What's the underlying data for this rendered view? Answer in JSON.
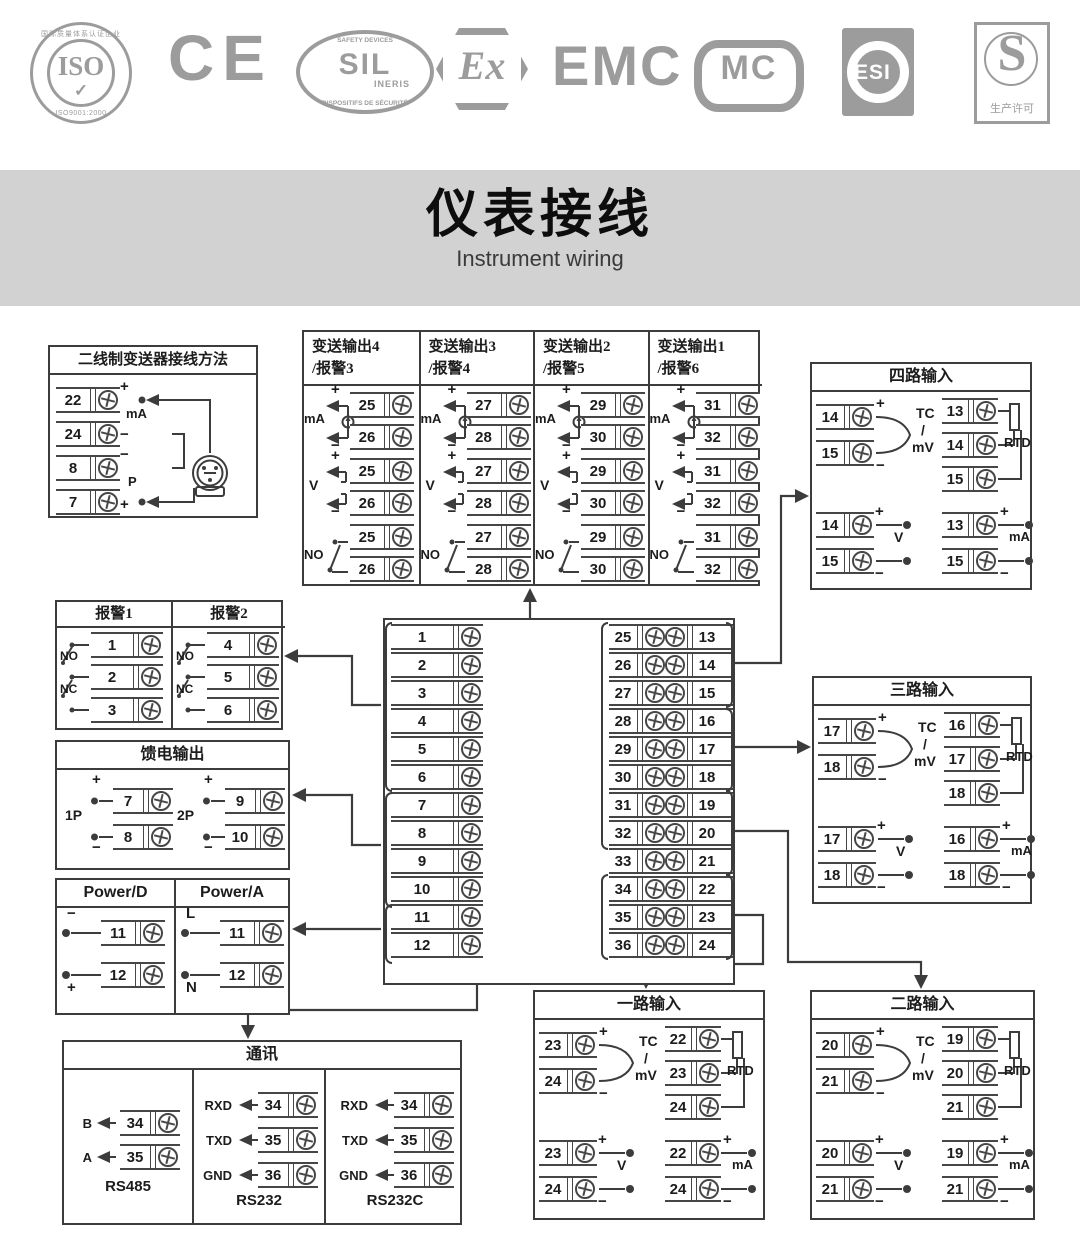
{
  "page": {
    "title_cn": "仪表接线",
    "title_en": "Instrument wiring",
    "banner_bg": "#d2d2d2",
    "line_color": "#3c3c3c",
    "logo_color": "#9c9c9c"
  },
  "logos": {
    "iso": {
      "label": "ISO",
      "ring_top": "国际质量体系认证企业",
      "ring_bottom": "ISO9001:2000",
      "check": "✓"
    },
    "ce": {
      "label": "CE"
    },
    "sil": {
      "arc_top": "SAFETY DEVICES",
      "label": "SIL",
      "sub": "INERIS",
      "arc_bottom": "DISPOSITIFS DE SÉCURITÉ"
    },
    "ex": {
      "label": "Ex"
    },
    "emc": {
      "label": "EMC"
    },
    "mc": {
      "label": "MC"
    },
    "esi": {
      "label": "ESI"
    },
    "license": {
      "label": "S",
      "caption": "生产许可"
    }
  },
  "labels": {
    "plus": "+",
    "minus": "−",
    "ma": "mA",
    "v": "V",
    "no": "NO",
    "nc": "NC",
    "tc": "TC",
    "slash": "/",
    "mv": "mV",
    "rtd": "RTD",
    "p": "P"
  },
  "two_wire_box": {
    "title": "二线制变送器接线方法",
    "rows": [
      {
        "num": "22",
        "sign": "+"
      },
      {
        "num": "24",
        "sign": "−"
      },
      {
        "num": "8",
        "sign": "−"
      },
      {
        "num": "7",
        "sign": "+"
      }
    ],
    "label_ma": "mA",
    "label_p": "P"
  },
  "transmit_box": {
    "columns": [
      {
        "title1": "变送输出4",
        "title2": "/报警3",
        "pair": [
          "25",
          "26"
        ]
      },
      {
        "title1": "变送输出3",
        "title2": "/报警4",
        "pair": [
          "27",
          "28"
        ]
      },
      {
        "title1": "变送输出2",
        "title2": "/报警5",
        "pair": [
          "29",
          "30"
        ]
      },
      {
        "title1": "变送输出1",
        "title2": "/报警6",
        "pair": [
          "31",
          "32"
        ]
      }
    ]
  },
  "input_boxes": [
    {
      "title": "四路输入",
      "tc": [
        "14",
        "15"
      ],
      "rtd": [
        "13",
        "14",
        "15"
      ],
      "v": [
        "14",
        "15"
      ],
      "ma": [
        "13",
        "15"
      ]
    },
    {
      "title": "三路输入",
      "tc": [
        "17",
        "18"
      ],
      "rtd": [
        "16",
        "17",
        "18"
      ],
      "v": [
        "17",
        "18"
      ],
      "ma": [
        "16",
        "18"
      ]
    },
    {
      "title": "一路输入",
      "tc": [
        "23",
        "24"
      ],
      "rtd": [
        "22",
        "23",
        "24"
      ],
      "v": [
        "23",
        "24"
      ],
      "ma": [
        "22",
        "24"
      ]
    },
    {
      "title": "二路输入",
      "tc": [
        "20",
        "21"
      ],
      "rtd": [
        "19",
        "20",
        "21"
      ],
      "v": [
        "20",
        "21"
      ],
      "ma": [
        "19",
        "21"
      ]
    }
  ],
  "alarm_box": {
    "columns": [
      {
        "title": "报警1",
        "terminals": [
          "1",
          "2",
          "3"
        ]
      },
      {
        "title": "报警2",
        "terminals": [
          "4",
          "5",
          "6"
        ]
      }
    ],
    "no": "NO",
    "nc": "NC"
  },
  "feed_box": {
    "title": "馈电输出",
    "groups": [
      {
        "label": "1P",
        "plus": "7",
        "minus": "8"
      },
      {
        "label": "2P",
        "plus": "9",
        "minus": "10"
      }
    ]
  },
  "power_box": {
    "columns": [
      {
        "title": "Power/D",
        "rows": [
          {
            "num": "11",
            "sign": "−"
          },
          {
            "num": "12",
            "sign": "+"
          }
        ]
      },
      {
        "title": "Power/A",
        "rows": [
          {
            "num": "11",
            "sign": "L"
          },
          {
            "num": "12",
            "sign": "N"
          }
        ]
      }
    ]
  },
  "comm_box": {
    "title": "通讯",
    "sections": [
      {
        "caption": "RS485",
        "rows": [
          {
            "sig": "B",
            "num": "34"
          },
          {
            "sig": "A",
            "num": "35"
          }
        ]
      },
      {
        "caption": "RS232",
        "rows": [
          {
            "sig": "RXD",
            "num": "34"
          },
          {
            "sig": "TXD",
            "num": "35"
          },
          {
            "sig": "GND",
            "num": "36"
          }
        ]
      },
      {
        "caption": "RS232C",
        "rows": [
          {
            "sig": "RXD",
            "num": "34"
          },
          {
            "sig": "TXD",
            "num": "35"
          },
          {
            "sig": "GND",
            "num": "36"
          }
        ]
      }
    ]
  },
  "center_block": {
    "left_terminals": [
      "1",
      "2",
      "3",
      "4",
      "5",
      "6",
      "7",
      "8",
      "9",
      "10",
      "11",
      "12"
    ],
    "mid_terminals": [
      "25",
      "26",
      "27",
      "28",
      "29",
      "30",
      "31",
      "32",
      "33",
      "34",
      "35",
      "36"
    ],
    "right_terminals": [
      "13",
      "14",
      "15",
      "16",
      "17",
      "18",
      "19",
      "20",
      "21",
      "22",
      "23",
      "24"
    ]
  }
}
